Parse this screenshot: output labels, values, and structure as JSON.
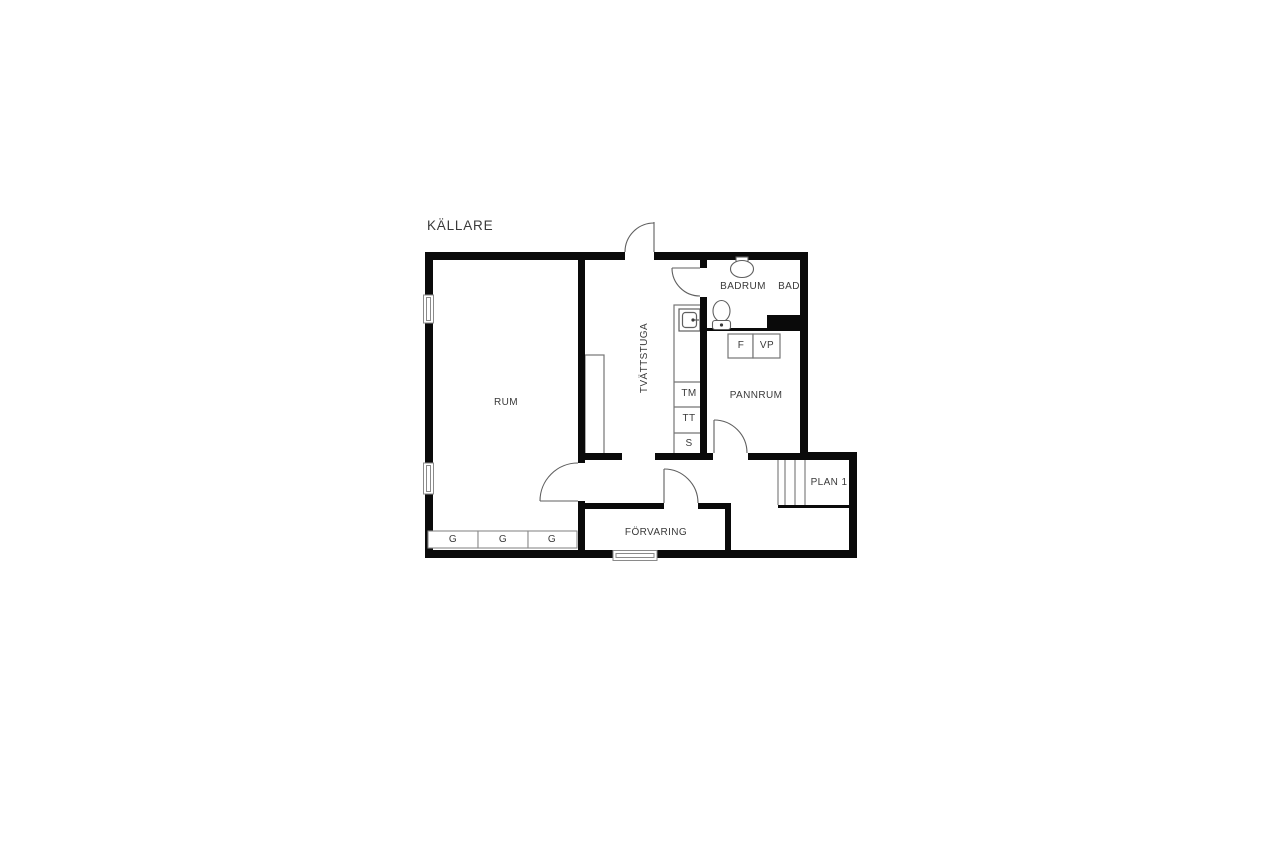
{
  "title": "KÄLLARE",
  "colors": {
    "wall": "#0a0a0a",
    "thin_line": "#757575",
    "door_line": "#5f5f5f",
    "text": "#3a3a3a",
    "background": "#ffffff"
  },
  "rooms": {
    "rum": "RUM",
    "tvattstuga": "TVÄTTSTUGA",
    "badrum": "BADRUM",
    "bad": "BAD",
    "pannrum": "PANNRUM",
    "forvaring": "FÖRVARING",
    "plan1": "PLAN 1"
  },
  "appliances": {
    "tm": "TM",
    "tt": "TT",
    "s": "S",
    "f": "F",
    "vp": "VP"
  },
  "closets": {
    "g1": "G",
    "g2": "G",
    "g3": "G"
  },
  "fixture_icons": [
    "toilet-icon",
    "washbasin-icon",
    "laundry-sink-icon",
    "stairs-icon",
    "window-icon",
    "door-swing-icon"
  ]
}
